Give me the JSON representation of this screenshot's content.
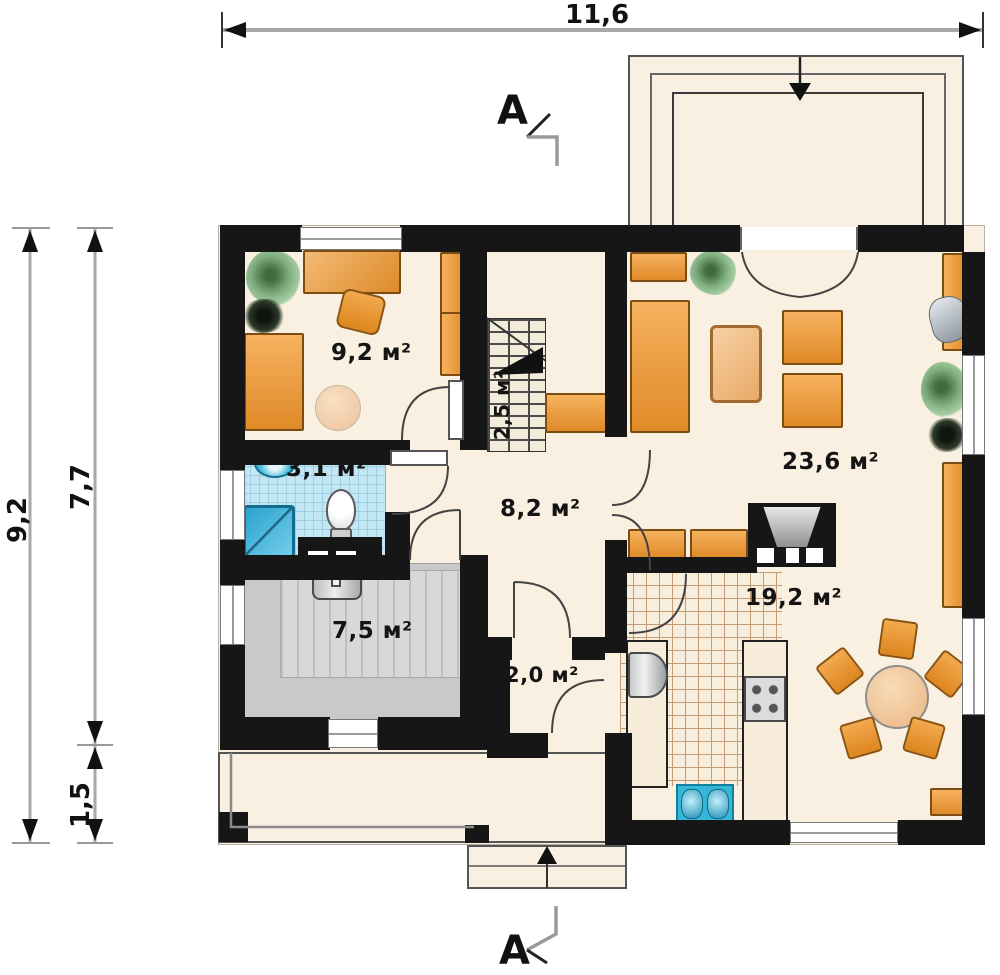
{
  "plan": {
    "dimensions": {
      "width_top": "11,6",
      "height_total": "9,2",
      "height_main": "7,7",
      "height_porch": "1,5"
    },
    "section_marker_top": "A",
    "section_marker_bottom": "A",
    "rooms": [
      {
        "id": "cabinet",
        "label": "9,2 м²"
      },
      {
        "id": "staircase",
        "label": "2,5 м²"
      },
      {
        "id": "bathroom",
        "label": "3,1 м²"
      },
      {
        "id": "hall",
        "label": "8,2 м²"
      },
      {
        "id": "boiler-room",
        "label": "7,5 м²"
      },
      {
        "id": "vestibule",
        "label": "2,0 м²"
      },
      {
        "id": "living-room",
        "label": "23,6 м²"
      },
      {
        "id": "kitchen-dining",
        "label": "19,2 м²"
      }
    ],
    "icons": [
      "plant-icon",
      "sofa-icon",
      "desk-icon",
      "armchair-icon",
      "coffee-table-icon",
      "wardrobe-icon",
      "washbasin-icon",
      "shower-icon",
      "toilet-icon",
      "boiler-icon",
      "fireplace-icon",
      "fridge-icon",
      "stove-icon",
      "sink-icon",
      "dining-table-icon",
      "chair-icon",
      "bench-icon",
      "lamp-icon",
      "stairs-arrow-icon",
      "entrance-arrow-icon",
      "terrace-arrow-icon"
    ],
    "colors": {
      "wall": "#161616",
      "floor": "#f9f0e1",
      "furniture_orange": "#e89038",
      "bathroom_blue": "#c3e6f4",
      "fixture_blue": "#31b0d5",
      "garage_gray": "#c9c9c9",
      "dimension_line": "#a8a8a8",
      "text": "#141414"
    }
  }
}
